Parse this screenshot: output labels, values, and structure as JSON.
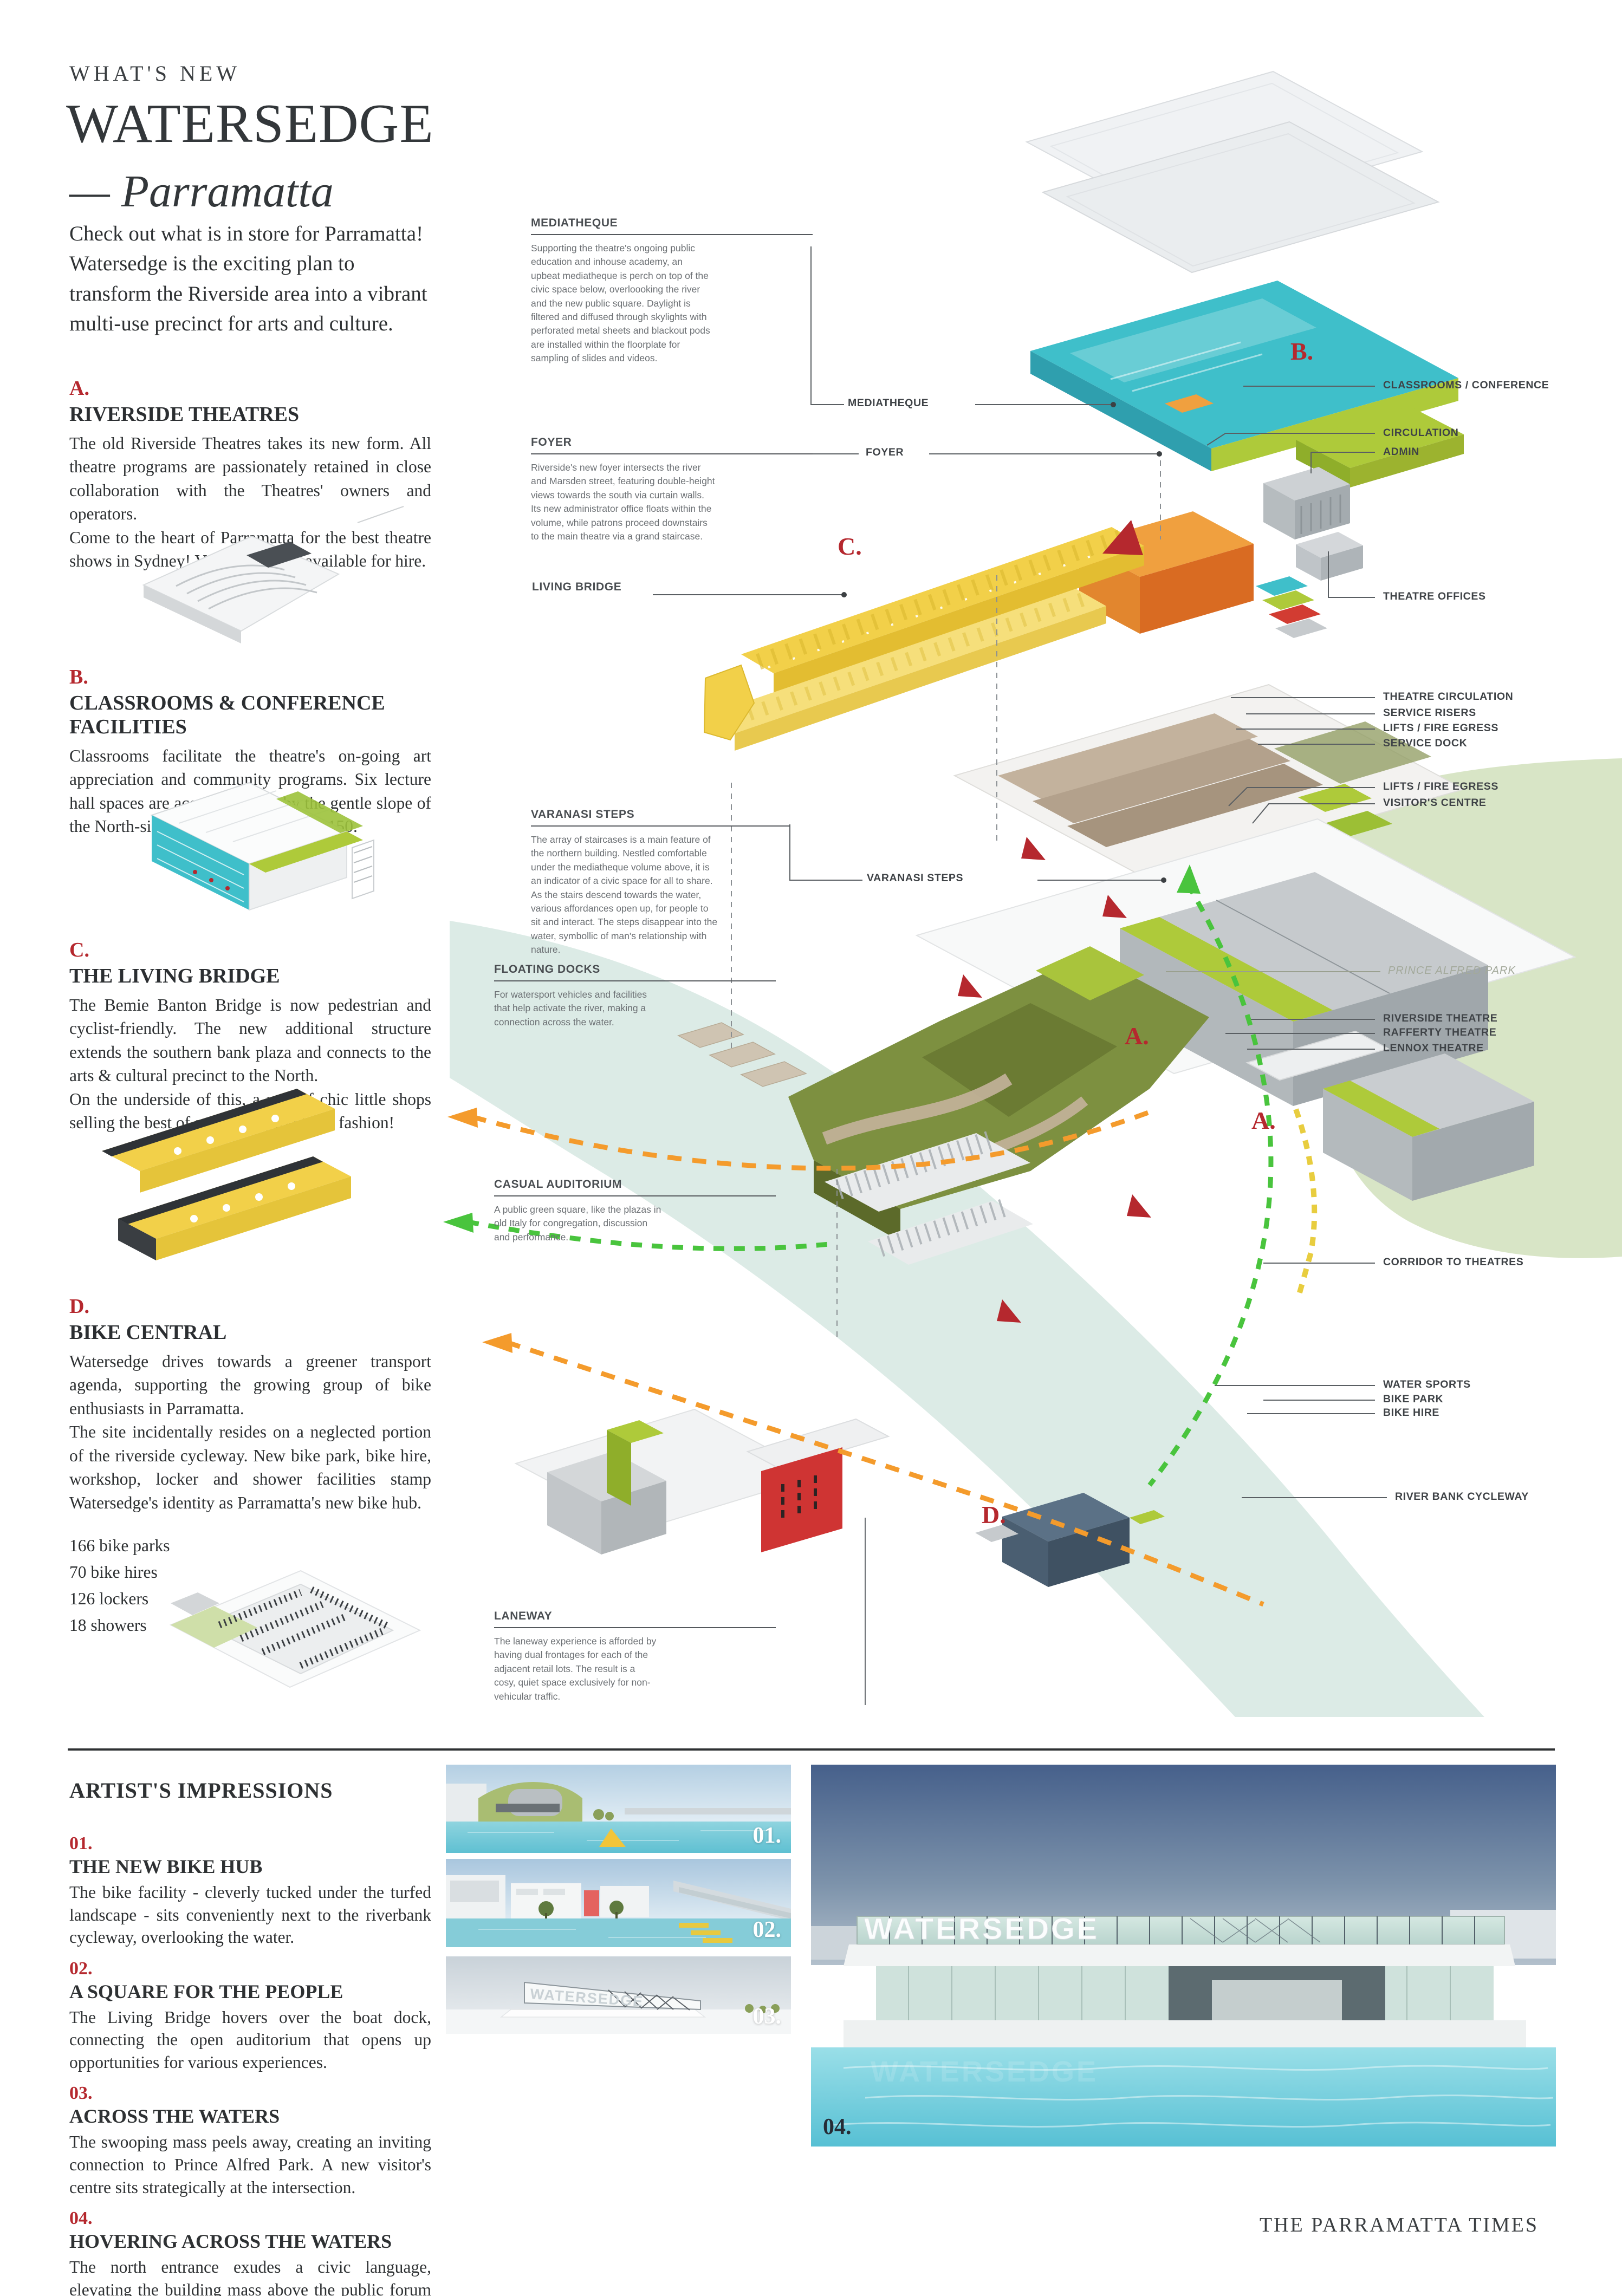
{
  "palette": {
    "accent": "#b5282e",
    "ink": "#2e3133",
    "label_ink": "#3f4347",
    "ann_ink": "#6b6f73",
    "teal": "#3fbfca",
    "teal_dark": "#2f9fae",
    "lime": "#aeca3a",
    "lime_dark": "#8fae2a",
    "yellow": "#f2d049",
    "yellow_dark": "#e3bd31",
    "orange": "#f0a03f",
    "orange_dark": "#d96b22",
    "olive": "#7d9040",
    "tan": "#b3a18c",
    "grey_vol": "#c6cacd",
    "river": "#dcebe6",
    "park": "#d8e5c6"
  },
  "header": {
    "kicker": "WHAT'S NEW",
    "title": "WATERSEDGE",
    "subtitle": "— Parramatta",
    "intro": "Check out what is in store for Parramatta! Watersedge is the exciting plan to transform the Riverside area into a vibrant multi-use precinct for arts and culture."
  },
  "sections": [
    {
      "letter": "A.",
      "heading": "RIVERSIDE THEATRES",
      "body": "The old Riverside Theatres takes its new form. All theatre programs are  passionately retained in close collaboration with the Theatres' owners and operators.\nCome to the heart of Parramatta for the best theatre shows in Sydney! Venues are also available for hire."
    },
    {
      "letter": "B.",
      "heading": "CLASSROOMS & CONFERENCE FACILITIES",
      "body": "Classrooms facilitate the theatre's on-going art appreciation and community programs. Six lecture hall spaces are acoommodated by the gentle slope of the North-side ramps. Each hall seats 150."
    },
    {
      "letter": "C.",
      "heading": "THE LIVING BRIDGE",
      "body": "The Bemie Banton Bridge is now pedestrian and cyclist-friendly. The new additional structure extends the southern bank plaza and connects to the arts & cultural precinct to the North.\nOn the underside of this, a row of chic little shops selling the best of arts, crafts, food and fashion!"
    },
    {
      "letter": "D.",
      "heading": "BIKE CENTRAL",
      "body": "Watersedge drives towards a greener transport agenda, supporting the growing group of bike enthusiasts in Parramatta.\nThe site incidentally resides on a neglected portion of the riverside cycleway. New bike park, bike hire, workshop, locker and shower facilities stamp Watersedge's identity as Parramatta's new bike hub.",
      "stats": "166 bike parks\n70 bike hires\n126 lockers\n18 showers"
    }
  ],
  "diagram": {
    "annotations": [
      {
        "title": "MEDIATHEQUE",
        "body": "Supporting the theatre's ongoing public education and inhouse academy, an upbeat mediatheque is perch on top of the civic space below, overloooking the river and the new public square. Daylight is filtered and diffused through skylights with perforated metal sheets and blackout pods are installed within the floorplate for sampling of slides and videos."
      },
      {
        "title": "FOYER",
        "body": "Riverside's new foyer intersects the river and Marsden street, featuring double-height views towards the south via curtain walls. Its new administrator office floats within the volume, while patrons proceed downstairs to the main theatre via a grand staircase."
      },
      {
        "title": "VARANASI STEPS",
        "body": "The array of staircases is a main feature of the northern building. Nestled comfortable under the mediatheque volume above, it is an indicator of a civic space for all to share. As the stairs descend towards the water, various affordances open up, for people to sit and interact. The steps disappear into the water, symbollic of man's relationship with nature."
      },
      {
        "title": "FLOATING DOCKS",
        "body": "For watersport vehicles and facilities that help activate the river, making a connection  across the water."
      },
      {
        "title": "CASUAL AUDITORIUM",
        "body": "A public green square, like the plazas in old Italy for congregation, discussion and performance."
      },
      {
        "title": "LANEWAY",
        "body": "The laneway experience is afforded by having dual frontages for each of the adjacent retail lots. The result is a cosy, quiet space exclusively for non-vehicular traffic."
      }
    ],
    "living_bridge_label": "LIVING BRIDGE",
    "center_labels": [
      "MEDIATHEQUE",
      "FOYER",
      "VARANASI STEPS"
    ],
    "right_labels": [
      "CLASSROOMS / CONFERENCE",
      "CIRCULATION",
      "ADMIN",
      "THEATRE OFFICES",
      "THEATRE CIRCULATION",
      "SERVICE RISERS",
      "LIFTS / FIRE EGRESS",
      "SERVICE DOCK",
      "LIFTS / FIRE EGRESS",
      "VISITOR'S CENTRE",
      "PRINCE ALFRED PARK",
      "RIVERSIDE THEATRE",
      "RAFFERTY THEATRE",
      "LENNOX THEATRE",
      "CORRIDOR TO THEATRES",
      "WATER SPORTS",
      "BIKE PARK",
      "BIKE HIRE",
      "RIVER BANK CYCLEWAY"
    ],
    "markers": [
      "B.",
      "C.",
      "A.",
      "A.",
      "D."
    ]
  },
  "impressions": {
    "heading": "ARTIST'S IMPRESSIONS",
    "items": [
      {
        "number": "01.",
        "heading": "THE NEW BIKE HUB",
        "body": "The bike facility - cleverly tucked under the turfed landscape - sits conveniently next to the riverbank cycleway, overlooking the water."
      },
      {
        "number": "02.",
        "heading": "A SQUARE FOR THE PEOPLE",
        "body": "The Living Bridge hovers over the boat dock, connecting the open auditorium that opens up opportunities for various experiences."
      },
      {
        "number": "03.",
        "heading": "ACROSS THE WATERS",
        "body": "The swooping mass peels away, creating an inviting connection to Prince Alfred Park. A new visitor's centre sits strategically at the intersection."
      },
      {
        "number": "04.",
        "heading": "HOVERING ACROSS THE WATERS",
        "body": "The north entrance exudes a civic language, elevating the building mass above the public forum space."
      }
    ]
  },
  "renders": {
    "sign_text": "WATERSEDGE",
    "labels": [
      "01.",
      "02.",
      "03.",
      "04."
    ]
  },
  "footer": "THE PARRAMATTA TIMES"
}
